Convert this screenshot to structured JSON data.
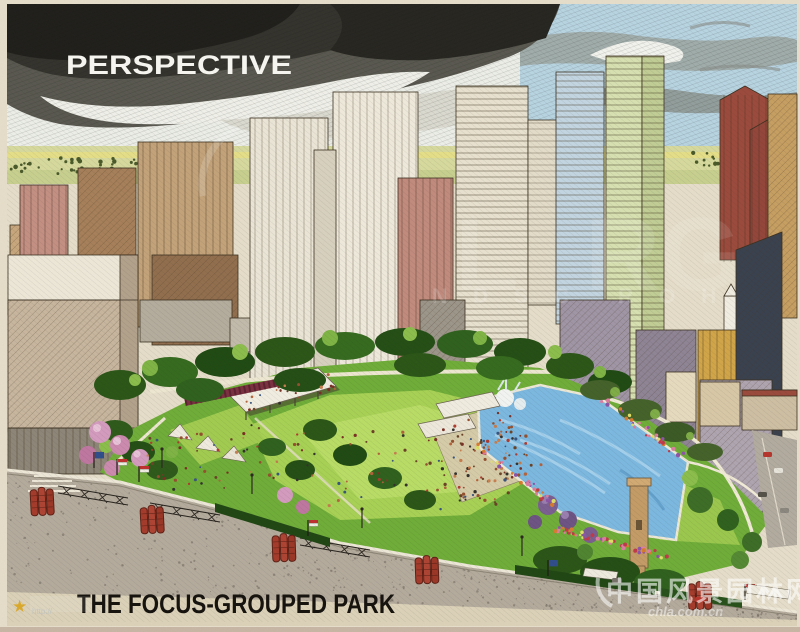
{
  "artwork": {
    "eyebrow": "PERSPECTIVE",
    "title": "THE FOCUS-GROUPED PARK"
  },
  "watermarks": {
    "ghost_letters_large_left": "L",
    "ghost_letters_large_right": "RG",
    "ghost_letters_small_left": "N D S C",
    "ghost_letters_small_right": "R O H",
    "corner_badge": {
      "icon": "star-icon",
      "text": "http://"
    },
    "site": {
      "name": "中国风景园林网",
      "domain": "chla.com.cn"
    }
  },
  "palette": {
    "paper": "#e7dfcb",
    "storm_sky": "#23221d",
    "lawn_green": "#a8d355",
    "tree_green": "#2a5617",
    "pool_blue": "#7cb9e2",
    "banner_red": "#a63b2b",
    "title_ink": "#17130e"
  }
}
